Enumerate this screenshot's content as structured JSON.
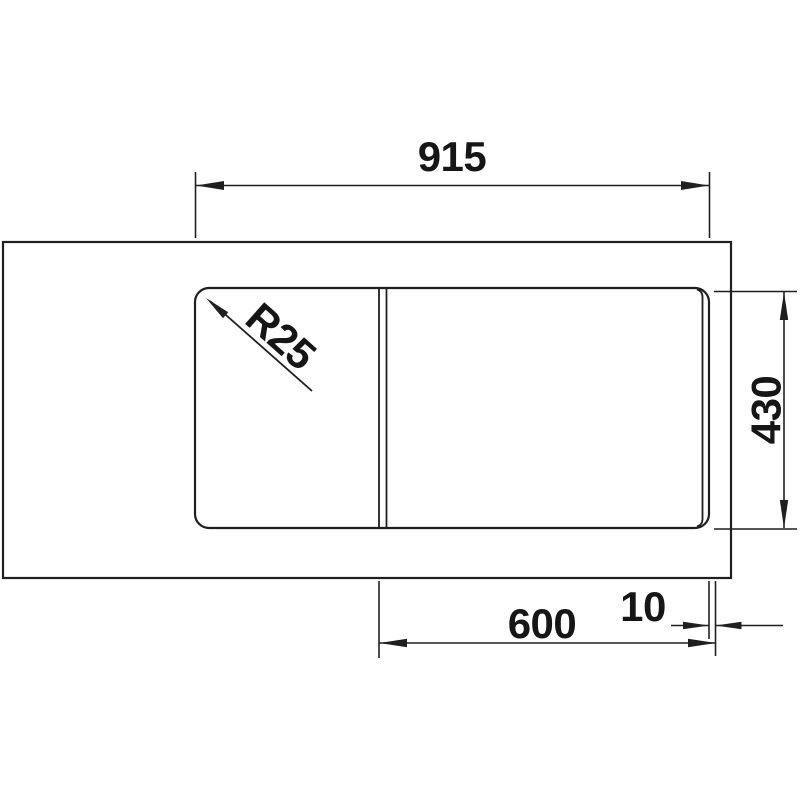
{
  "drawing": {
    "dim_overall_width": "915",
    "dim_overall_depth": "430",
    "dim_cabinet_width": "600",
    "dim_overhang": "10",
    "label_corner_radius": "R25",
    "line_color": "#1f1f1f",
    "background_color": "#ffffff"
  }
}
